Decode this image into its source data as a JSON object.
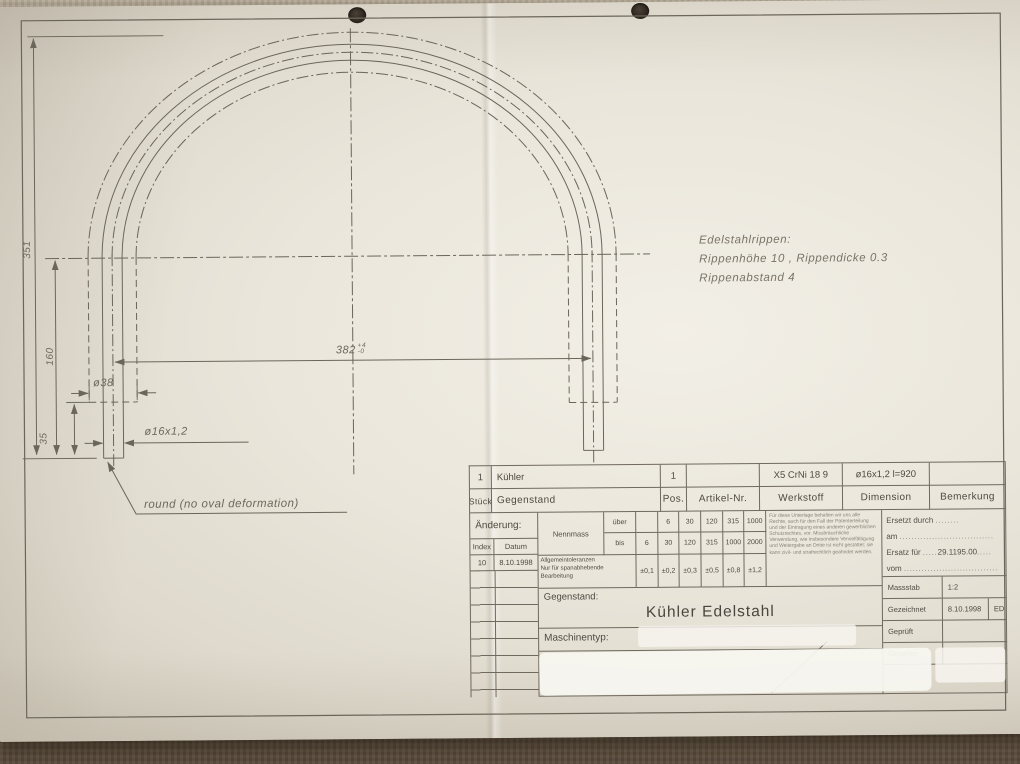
{
  "colors": {
    "paper": "#eae6db",
    "line": "#6b665a",
    "backdrop": "#978b77"
  },
  "drawing": {
    "notes": {
      "ribs_title": "Edelstahlrippen:",
      "ribs_line2": "Rippenhöhe 10 , Rippendicke 0.3",
      "ribs_line3": "Rippenabstand 4",
      "round_note": "round  (no oval deformation)"
    },
    "dims": {
      "total_height": "351",
      "leg_height": "160",
      "end_length": "35",
      "rib_dia": "ø38",
      "tube_dia": "ø16x1,2",
      "span": "382",
      "span_tol_upper": "+4",
      "span_tol_lower": "-0"
    }
  },
  "titleblock": {
    "row1": {
      "qty": "1",
      "item": "Kühler",
      "pos": "1",
      "artikel": "",
      "werkstoff": "X5 CrNi 18 9",
      "dimension": "ø16x1,2 l=920",
      "bemerkung": ""
    },
    "headers": {
      "stueck": "Stück",
      "gegenstand": "Gegenstand",
      "pos": "Pos.",
      "artikel": "Artikel-Nr.",
      "werkstoff": "Werkstoff",
      "dimension": "Dimension",
      "bemerkung": "Bemerkung"
    },
    "aenderung": {
      "label": "Änderung:",
      "index": "Index",
      "datum": "Datum",
      "index_value": "10",
      "datum_value": "8.10.1998"
    },
    "tol": {
      "nennmass": "Nennmass",
      "ueber": "über",
      "bis": "bis",
      "ueber_values": [
        "",
        "6",
        "30",
        "120",
        "315",
        "1000"
      ],
      "bis_values": [
        "6",
        "30",
        "120",
        "315",
        "1000",
        "2000"
      ],
      "allg1": "Allgemeintoleranzen",
      "allg2": "Nur für spanabhebende",
      "allg3": "Bearbeitung",
      "values": [
        "±0,1",
        "±0,2",
        "±0,3",
        "±0,5",
        "±0,8",
        "±1,2"
      ]
    },
    "legal": "Für diese Unterlage behalten wir uns alle Rechte, auch für den Fall der Patenterteilung und der Eintragung eines anderen gewerblichen Schutzrechtes, vor. Missbräuchliche Verwendung, wie insbesondere Vervielfältigung und Weitergabe an Dritte ist nicht gestattet; sie kann zivil- und strafrechtlich geahndet werden.",
    "ersatz": {
      "l1": "Ersetzt durch",
      "l2": "am",
      "l3": "Ersatz für",
      "l3_value": "29.1195.00",
      "l4": "vom",
      "dots_long": "................................",
      "dots_mid": "........",
      "dots_short": "....."
    },
    "gegenstand_label": "Gegenstand:",
    "gegenstand_value": "Kühler Edelstahl",
    "maschinentyp_label": "Maschinentyp:",
    "meta": {
      "massstab": "Massstab",
      "massstab_value": "1:2",
      "gezeichnet": "Gezeichnet",
      "gezeichnet_date": "8.10.1998",
      "gezeichnet_initials": "ED",
      "geprueft": "Geprüft",
      "gesehen": "Gesehen"
    }
  }
}
